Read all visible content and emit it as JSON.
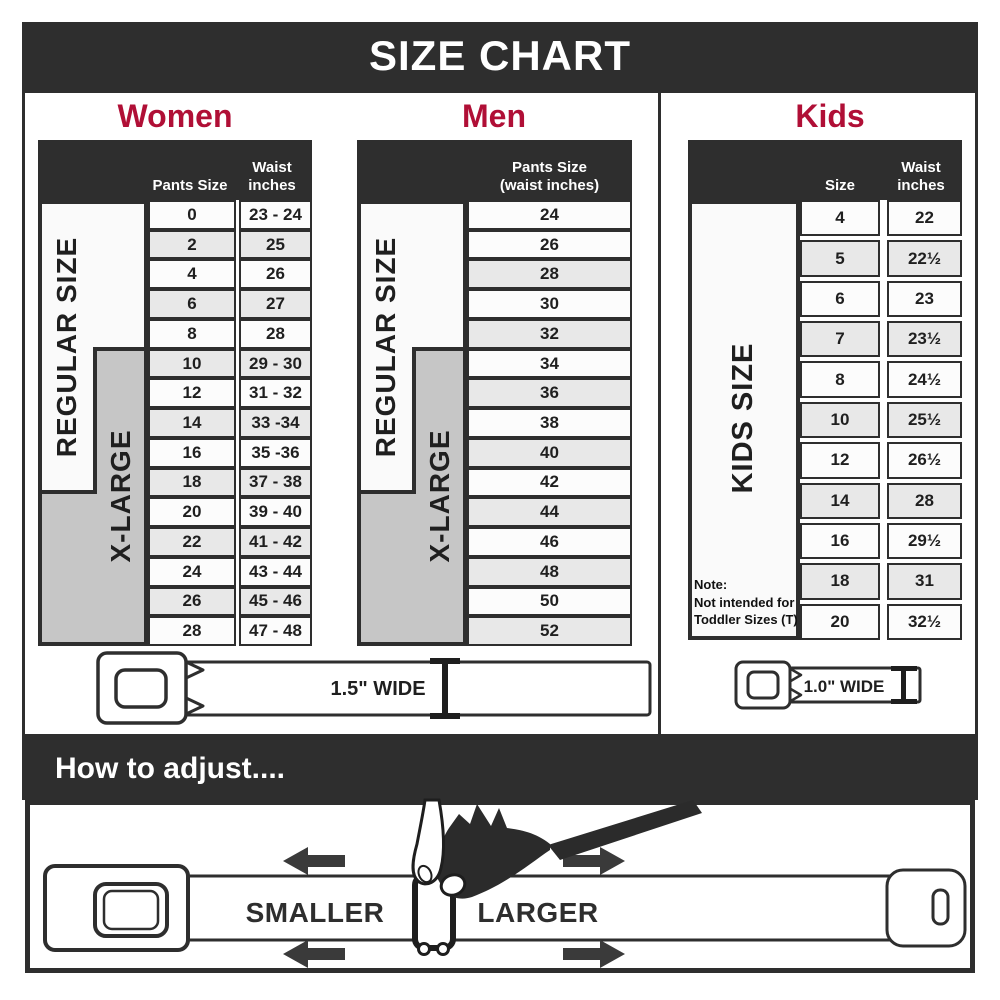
{
  "header": {
    "title": "SIZE CHART"
  },
  "colors": {
    "accent": "#b00f36",
    "dark": "#2e2e2e",
    "row_alt": "#e8e8e8",
    "xlarge_gray": "#c6c6c6"
  },
  "labels": {
    "regular": "REGULAR SIZE",
    "xlarge": "X-LARGE",
    "kids": "KIDS SIZE"
  },
  "belts": {
    "wide_15": "1.5\" WIDE",
    "wide_10": "1.0\" WIDE"
  },
  "women": {
    "heading": "Women",
    "col_pants": "Pants Size",
    "col_waist": [
      "Waist",
      "inches"
    ],
    "rows": [
      {
        "size": "0",
        "waist": "23 - 24"
      },
      {
        "size": "2",
        "waist": "25"
      },
      {
        "size": "4",
        "waist": "26"
      },
      {
        "size": "6",
        "waist": "27"
      },
      {
        "size": "8",
        "waist": "28"
      },
      {
        "size": "10",
        "waist": "29 - 30"
      },
      {
        "size": "12",
        "waist": "31 - 32"
      },
      {
        "size": "14",
        "waist": "33 -34"
      },
      {
        "size": "16",
        "waist": "35 -36"
      },
      {
        "size": "18",
        "waist": "37 - 38"
      },
      {
        "size": "20",
        "waist": "39 - 40"
      },
      {
        "size": "22",
        "waist": "41 - 42"
      },
      {
        "size": "24",
        "waist": "43 - 44"
      },
      {
        "size": "26",
        "waist": "45 - 46"
      },
      {
        "size": "28",
        "waist": "47 - 48"
      }
    ]
  },
  "men": {
    "heading": "Men",
    "col_pants": [
      "Pants Size",
      "(waist inches)"
    ],
    "rows": [
      "24",
      "26",
      "28",
      "30",
      "32",
      "34",
      "36",
      "38",
      "40",
      "42",
      "44",
      "46",
      "48",
      "50",
      "52"
    ]
  },
  "kids": {
    "heading": "Kids",
    "col_size": "Size",
    "col_waist": [
      "Waist",
      "inches"
    ],
    "note": [
      "Note:",
      "Not intended for",
      "Toddler Sizes (T)"
    ],
    "rows": [
      {
        "size": "4",
        "waist": "22"
      },
      {
        "size": "5",
        "waist": "22½"
      },
      {
        "size": "6",
        "waist": "23"
      },
      {
        "size": "7",
        "waist": "23½"
      },
      {
        "size": "8",
        "waist": "24½"
      },
      {
        "size": "10",
        "waist": "25½"
      },
      {
        "size": "12",
        "waist": "26½"
      },
      {
        "size": "14",
        "waist": "28"
      },
      {
        "size": "16",
        "waist": "29½"
      },
      {
        "size": "18",
        "waist": "31"
      },
      {
        "size": "20",
        "waist": "32½"
      }
    ]
  },
  "adjust": {
    "heading": "How to adjust....",
    "smaller": "SMALLER",
    "larger": "LARGER"
  }
}
